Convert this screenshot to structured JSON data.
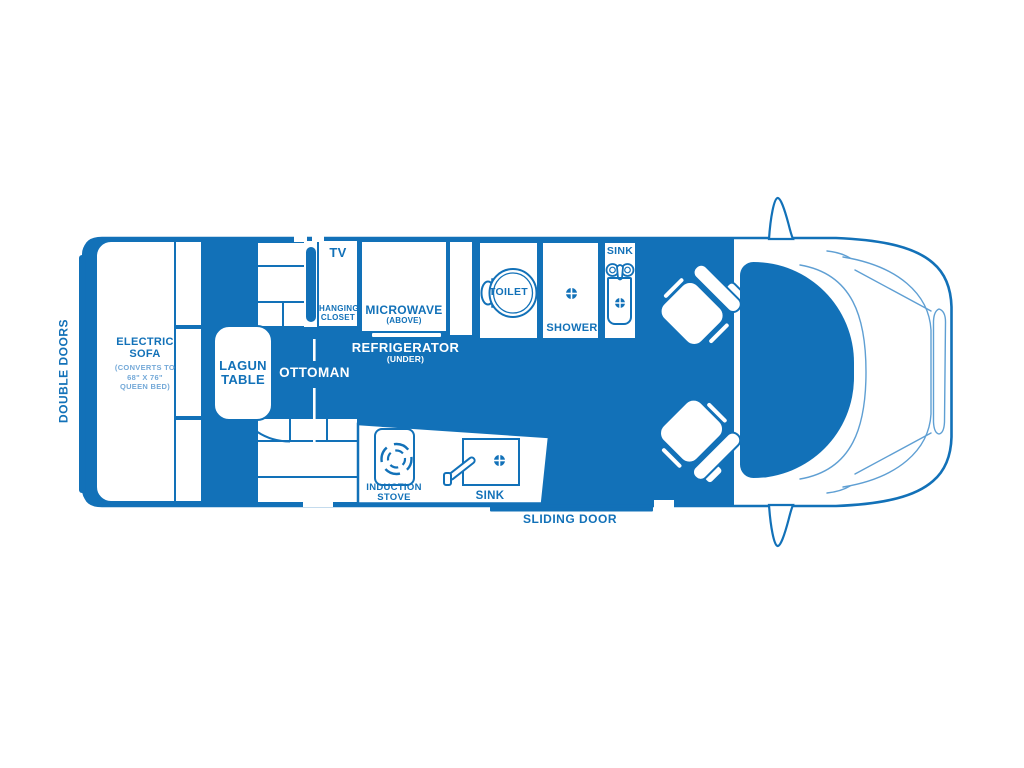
{
  "diagram_type": "camper-van-floor-plan",
  "colors": {
    "primary_blue": "#1271b8",
    "light_blue": "#74a9d8",
    "detail_line_blue": "#5f9fd3",
    "background": "#ffffff"
  },
  "labels": {
    "double_doors": "DOUBLE DOORS",
    "sliding_door": "SLIDING DOOR",
    "ottoman": "OTTOMAN",
    "tv": "TV",
    "hanging_closet": {
      "line1": "HANGING",
      "line2": "CLOSET"
    },
    "microwave": {
      "name": "MICROWAVE",
      "sub": "(ABOVE)"
    },
    "refrigerator": {
      "name": "REFRIGERATOR",
      "sub": "(UNDER)"
    },
    "electric_sofa": {
      "line1": "ELECTRIC",
      "line2": "SOFA",
      "note1": "(CONVERTS TO",
      "note2": "68\" X 76\"",
      "note3": "QUEEN BED)"
    },
    "lagun_table": {
      "line1": "LAGUN",
      "line2": "TABLE"
    },
    "toilet": "TOILET",
    "shower": "SHOWER",
    "bath_sink": "SINK",
    "kitchen_sink": "SINK",
    "induction_stove": {
      "line1": "INDUCTION",
      "line2": "STOVE"
    }
  },
  "icons": {
    "toilet": "toilet-top-view",
    "shower_drain": "drain",
    "bath_faucet": "two-knob-faucet",
    "kitchen_faucet": "lever-faucet",
    "stove": "induction-burner-rings",
    "seats": "swivel-captain-seat",
    "mirrors": "side-mirror-fin"
  }
}
